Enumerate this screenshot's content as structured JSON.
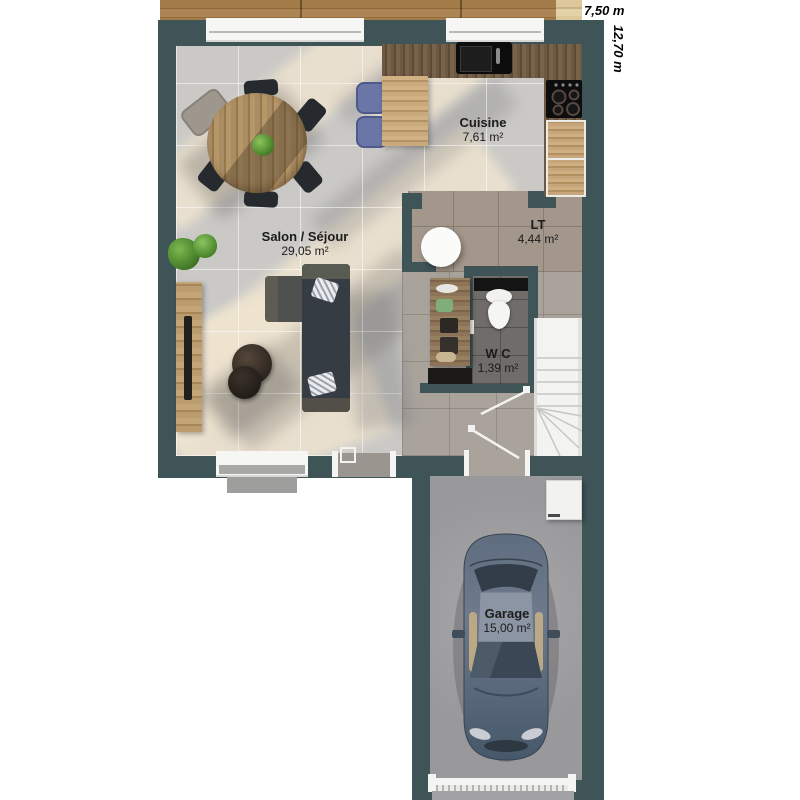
{
  "dimensions": {
    "width_label": "7,50 m",
    "height_label": "12,70 m"
  },
  "rooms": [
    {
      "name": "Cuisine",
      "area": "7,61 m²"
    },
    {
      "name": "Salon / Séjour",
      "area": "29,05 m²"
    },
    {
      "name": "LT",
      "area": "4,44 m²"
    },
    {
      "name": "W C",
      "area": "1,39 m²"
    },
    {
      "name": "Garage",
      "area": "15,00 m²"
    }
  ],
  "colors": {
    "wall": "#3e5457",
    "living_floor": "#cac9c6",
    "sunlight_patch": "#f0e5d0",
    "lt_floor": "#a3978b",
    "hallway_floor": "#a9a39c",
    "wc_floor": "#6f6c69",
    "garage_floor": "#99999b",
    "deck_wood": "#a37c49",
    "counter_wood": "#6d5942",
    "cabinet_wood": "#c6a67a",
    "sofa": "#363c43",
    "stool_blue": "#6a76a6",
    "car_body": "#5d6d80",
    "stairs": "#f3f3f2"
  }
}
